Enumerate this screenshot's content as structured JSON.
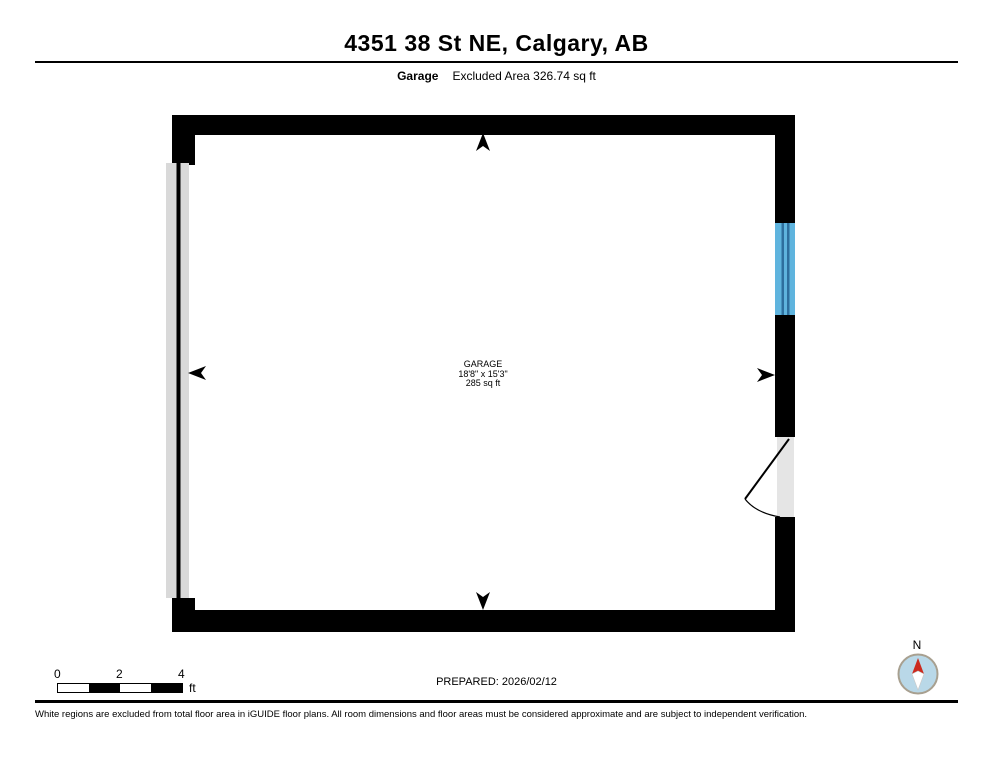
{
  "header": {
    "title": "4351 38 St NE, Calgary, AB",
    "floor_label": "Garage",
    "excluded_area": "Excluded Area 326.74 sq ft"
  },
  "floorplan": {
    "room": {
      "name": "GARAGE",
      "dimensions": "18'8\" x 15'3\"",
      "area": "285 sq ft"
    },
    "features": {
      "left_wall": "garage-door",
      "right_wall_upper": "window",
      "right_wall_lower": "door-with-swing"
    }
  },
  "scale_bar": {
    "labels": [
      "0",
      "2",
      "4"
    ],
    "unit": "ft"
  },
  "footer": {
    "prepared": "PREPARED: 2026/02/12",
    "compass_label": "N",
    "disclaimer": "White regions are excluded from total floor area in iGUIDE floor plans. All room dimensions and floor areas must be considered approximate and are subject to independent verification."
  },
  "colors": {
    "wall": "#000000",
    "window_fill": "#5fb4de",
    "window_line": "#2e6f9e",
    "door_fill": "#e5e5e5",
    "garage_door_fill": "#d9d9d9",
    "compass_fill": "#b9d8e8",
    "compass_border": "#a8a090",
    "needle_north": "#cc2a1e",
    "needle_south": "#ffffff"
  }
}
